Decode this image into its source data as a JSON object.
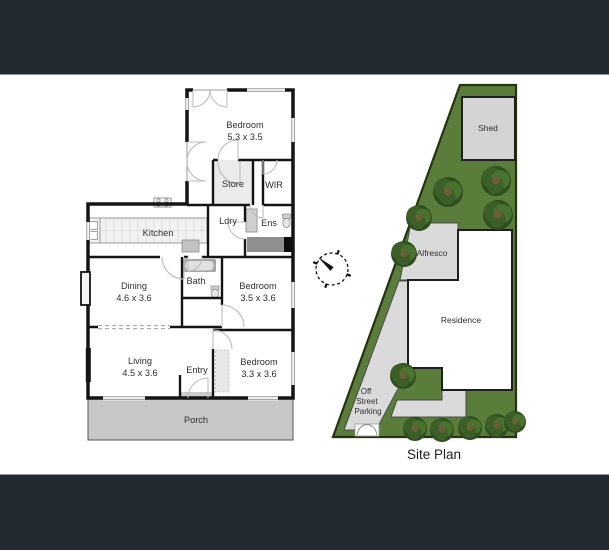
{
  "floor_plan": {
    "bedroom_top": {
      "name": "Bedroom",
      "dims": "5.3 x 3.5"
    },
    "store": {
      "name": "Store"
    },
    "wir": {
      "name": "WIR"
    },
    "ldry": {
      "name": "Ldry"
    },
    "ens": {
      "name": "Ens"
    },
    "kitchen": {
      "name": "Kitchen"
    },
    "dining": {
      "name": "Dining",
      "dims": "4.6 x 3.6"
    },
    "bath": {
      "name": "Bath"
    },
    "bedroom_mid": {
      "name": "Bedroom",
      "dims": "3.5 x 3.6"
    },
    "living": {
      "name": "Living",
      "dims": "4.5 x 3.6"
    },
    "entry": {
      "name": "Entry"
    },
    "bedroom_bottom": {
      "name": "Bedroom",
      "dims": "3.3 x 3.6"
    },
    "porch": {
      "name": "Porch"
    }
  },
  "site_plan": {
    "title": "Site Plan",
    "shed": "Shed",
    "alfresco": "Alfresco",
    "residence": "Residence",
    "parking_lines": [
      "Off",
      "Street",
      "Parking"
    ]
  },
  "icons": {
    "compass": "north-compass-icon"
  },
  "colors": {
    "top_bar": "#232931",
    "bottom_bar": "#232931",
    "site_green": "#5b7d3c",
    "site_border": "#26330f",
    "wall": "#141414",
    "porch_gray": "#c7c7c7",
    "paving_gray": "#dadada"
  }
}
